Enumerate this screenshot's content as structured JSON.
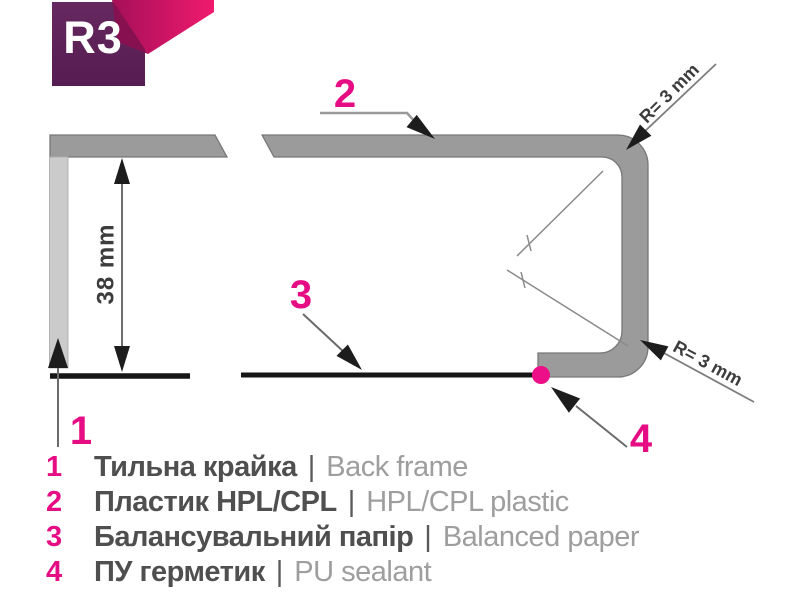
{
  "badge": {
    "label": "R3"
  },
  "diagram": {
    "dimension_label": "38 mm",
    "radius_label_top": "R= 3 mm",
    "radius_label_bottom": "R= 3 mm",
    "callout_1": "1",
    "callout_2": "2",
    "callout_3": "3",
    "callout_4": "4"
  },
  "legend": {
    "items": [
      {
        "num": "1",
        "uk": "Тильна крайка",
        "sep": "|",
        "en": "Back frame"
      },
      {
        "num": "2",
        "uk": "Пластик HPL/CPL",
        "sep": "|",
        "en": "HPL/CPL plastic"
      },
      {
        "num": "3",
        "uk": "Балансувальний папір",
        "sep": "|",
        "en": "Balanced paper"
      },
      {
        "num": "4",
        "uk": "ПУ герметик",
        "sep": "|",
        "en": "PU sealant"
      }
    ]
  },
  "colors": {
    "accent_pink": "#e60c84",
    "badge_purple": "#5c2059",
    "ribbon_pink": "#ee1c6d",
    "profile_gray": "#9b9b9b",
    "back_frame_gray": "#cbcbcb",
    "line_black": "#161616",
    "text_dark": "#4f4f4f",
    "text_light": "#9e9e9e"
  }
}
